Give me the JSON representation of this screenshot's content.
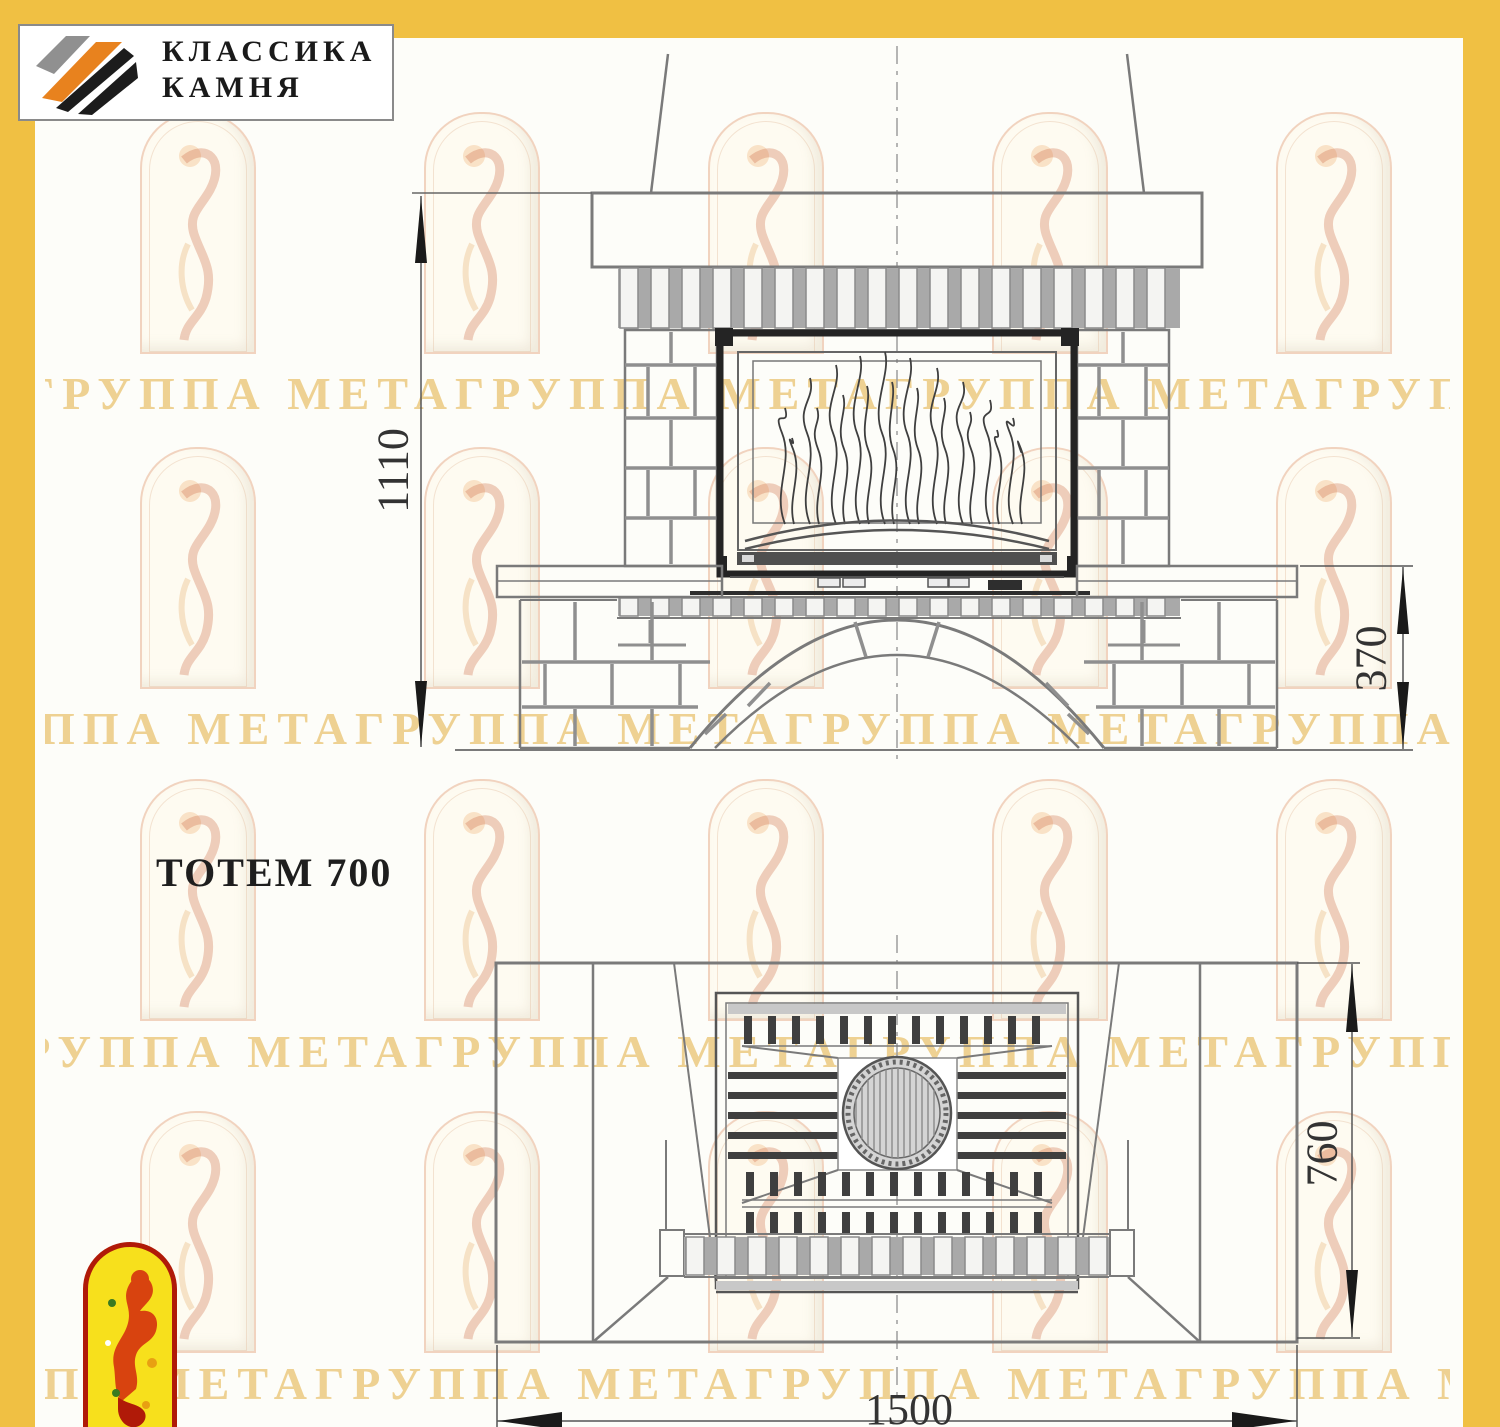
{
  "colors": {
    "band_yellow": "#f0c043",
    "line_gray": "#7a7a7a",
    "joint_gray": "#8f8f8f",
    "dark": "#242424",
    "logo_orange": "#e8821e",
    "badge_yellow": "#f7e01c",
    "badge_red": "#b01a08",
    "watermark_gold": "#eac678"
  },
  "header_logo": {
    "line1": "КЛАССИКА",
    "line2": "КАМНЯ"
  },
  "drawing": {
    "title": "ТОТЕМ 700",
    "dimensions": {
      "overall_height_mm": "1110",
      "bench_height_mm": "370",
      "plan_depth_mm": "760",
      "plan_width_mm": "1500"
    }
  },
  "watermark": {
    "text": "ГРУППА МЕТАГРУППА МЕТАГРУППА МЕТАГРУППА МЕТА ГРУППА МЕТАГРУППА"
  }
}
